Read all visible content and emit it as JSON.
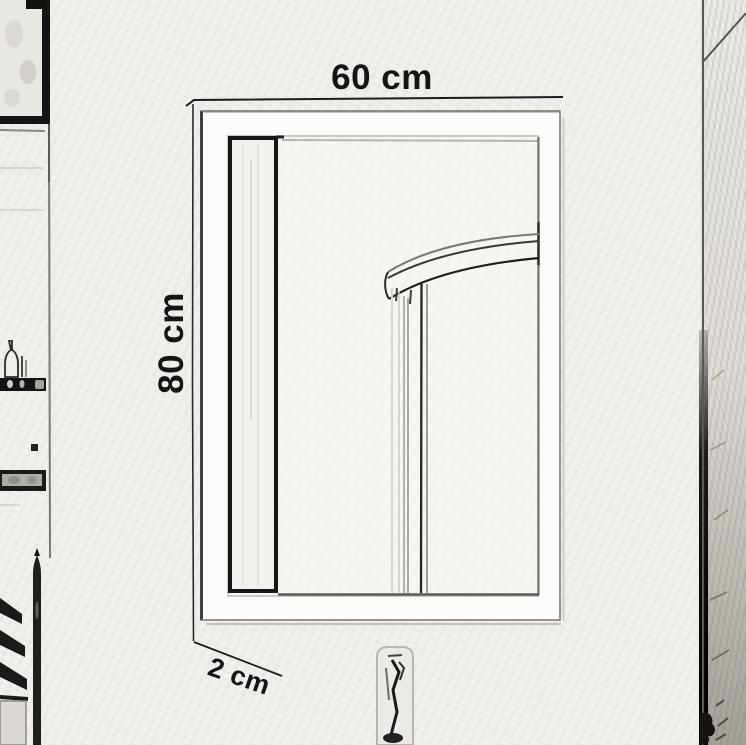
{
  "meta": {
    "description": "Pencil-sketch style product dimension drawing of a rectangular white wall mirror in a bathroom",
    "style": "hand-drawn line sketch on paper"
  },
  "dimension_labels": {
    "width": "60 cm",
    "height": "80 cm",
    "frame_depth": "2 cm"
  },
  "sketch_elements": {
    "mirror_frame": "white rectangular mirror frame",
    "reflection": "curved shower enclosure rail reflected in the mirror glass",
    "left_wall": "wall shelves with bottles, a plant stem and slatted rack",
    "right_wall": "room corner with textured door/wall edge",
    "below_mirror": "small faucet sketch under the mirror"
  },
  "colors": {
    "paper": "#f1f0ed",
    "ink_dark": "#1b1b1b",
    "ink_gray": "#8a8883",
    "frame_white": "#fcfcfa",
    "mirror_glass": "#f7f6f2",
    "shadow_gray": "#c6c3bf"
  }
}
